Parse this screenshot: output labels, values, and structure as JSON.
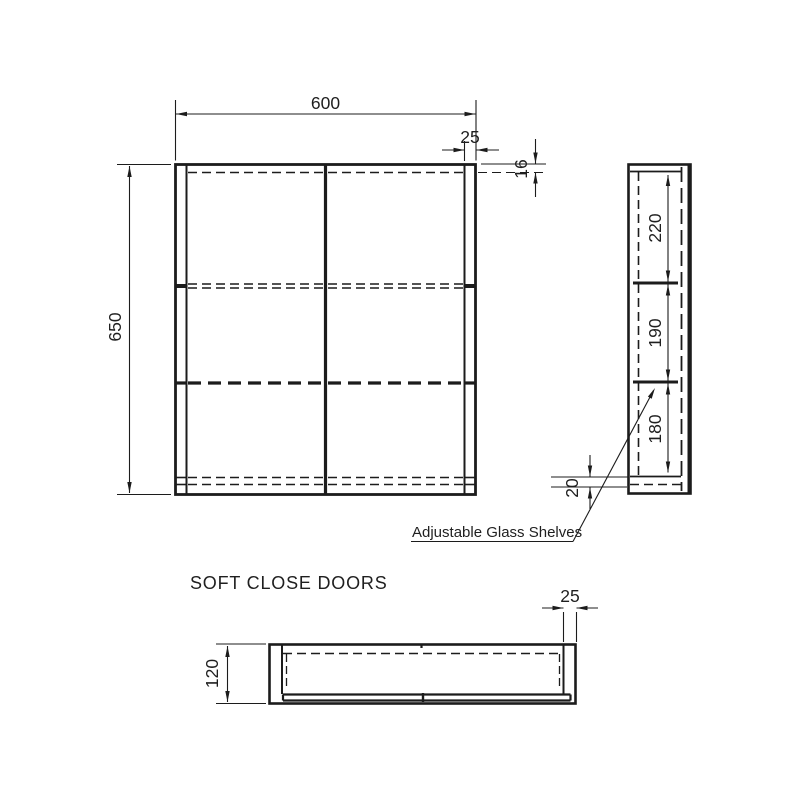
{
  "drawing": {
    "caption": "SOFT CLose DOORS_placeholder",
    "front": {
      "width": "600",
      "height": "650",
      "side_thickness": "25",
      "top_thickness": "16"
    },
    "side": {
      "section_top": "220",
      "section_middle": "190",
      "section_bottom": "180",
      "bottom_thickness": "20",
      "annotation": "Adjustable Glass Shelves"
    },
    "plan": {
      "depth": "120",
      "side_thickness": "25"
    }
  }
}
